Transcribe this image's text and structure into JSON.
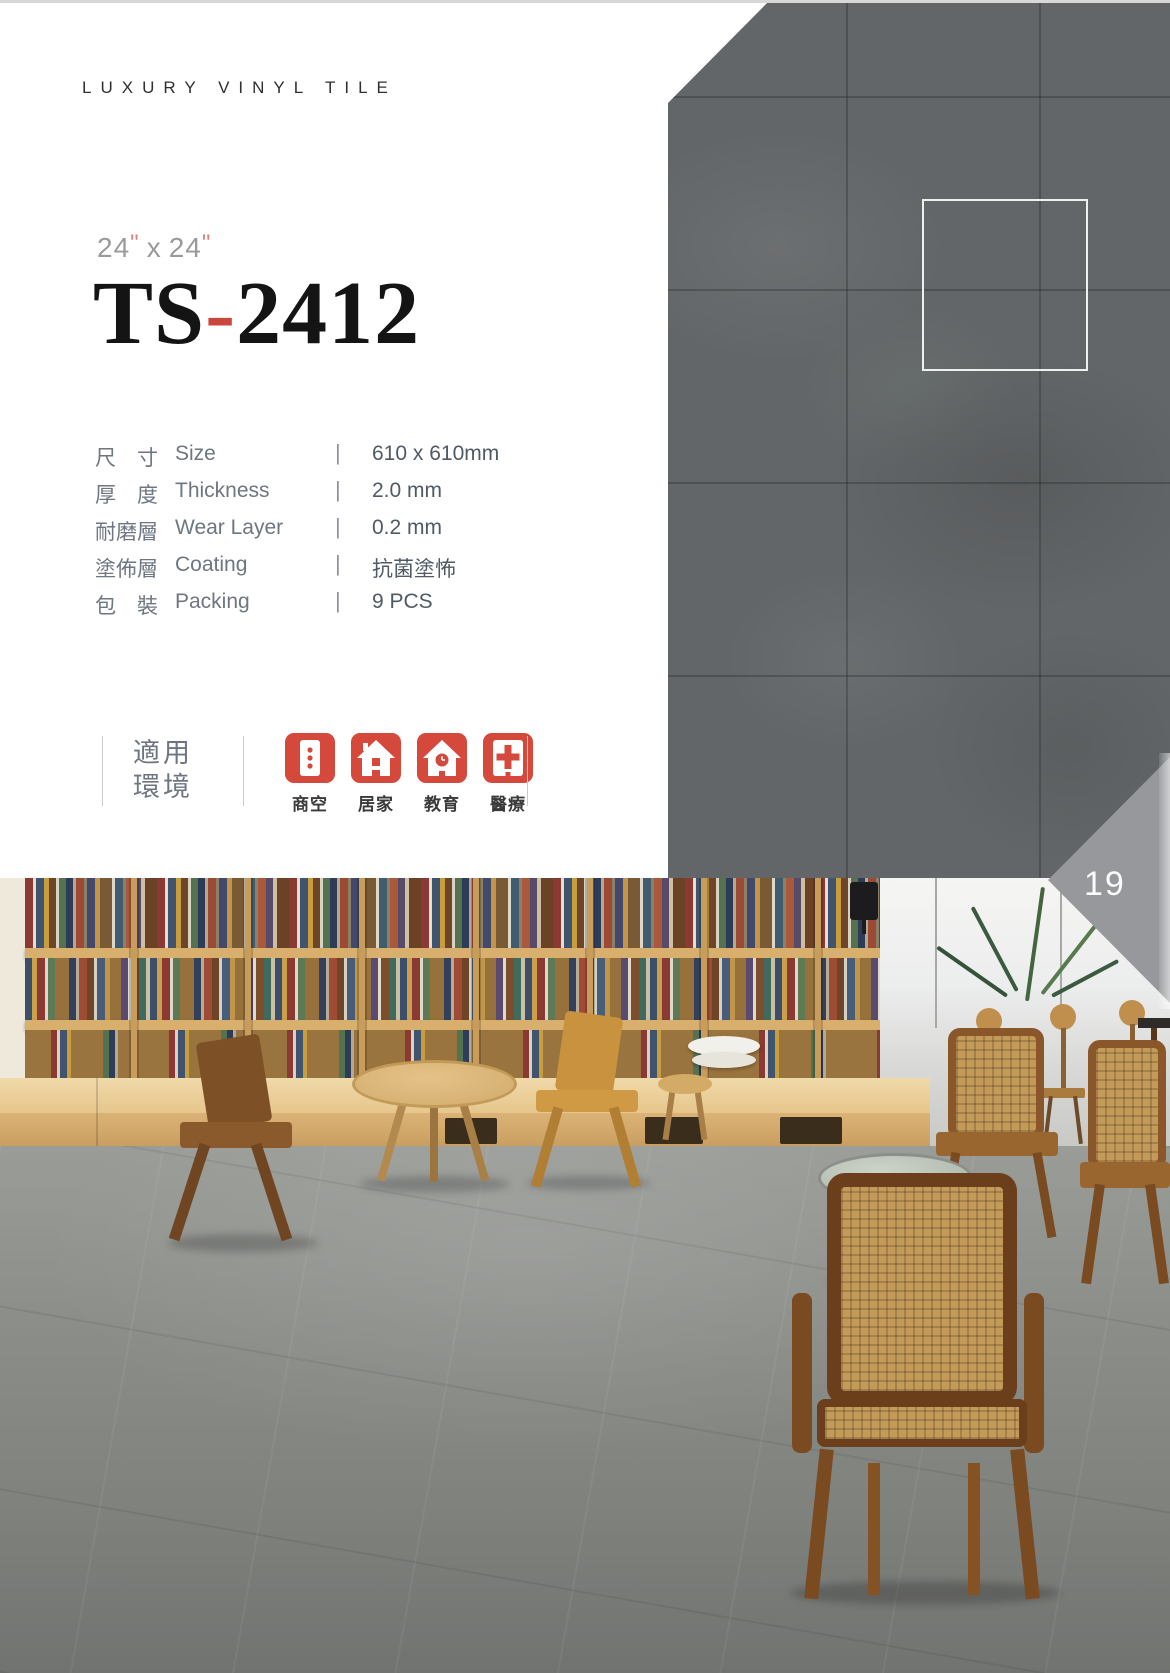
{
  "page": {
    "header": "LUXURY VINYL TILE",
    "page_number": "19"
  },
  "size": {
    "w": "24",
    "h": "24",
    "quote": "\"",
    "sep": "x"
  },
  "code": {
    "prefix": "TS",
    "sep": "-",
    "num": "2412"
  },
  "specs": {
    "separator": "|",
    "rows": [
      {
        "zh": "尺　寸",
        "en": "Size",
        "value": "610 x 610mm"
      },
      {
        "zh": "厚　度",
        "en": "Thickness",
        "value": "2.0 mm"
      },
      {
        "zh": "耐磨層",
        "en": "Wear Layer",
        "value": "0.2 mm"
      },
      {
        "zh": "塗佈層",
        "en": "Coating",
        "value": "抗菌塗怖"
      },
      {
        "zh": "包　裝",
        "en": "Packing",
        "value": "9 PCS"
      }
    ]
  },
  "environments": {
    "title_line1": "適用",
    "title_line2": "環境",
    "items": [
      {
        "label": "商空",
        "icon": "commercial-building-icon"
      },
      {
        "label": "居家",
        "icon": "home-icon"
      },
      {
        "label": "教育",
        "icon": "school-icon"
      },
      {
        "label": "醫療",
        "icon": "medical-cross-icon"
      }
    ]
  },
  "colors": {
    "accent_red": "#d5493d",
    "code_hyphen_red": "#c9473d",
    "tile_gray": "#636668",
    "badge_gray": "#96989c",
    "text_gray": "#6e7681"
  }
}
